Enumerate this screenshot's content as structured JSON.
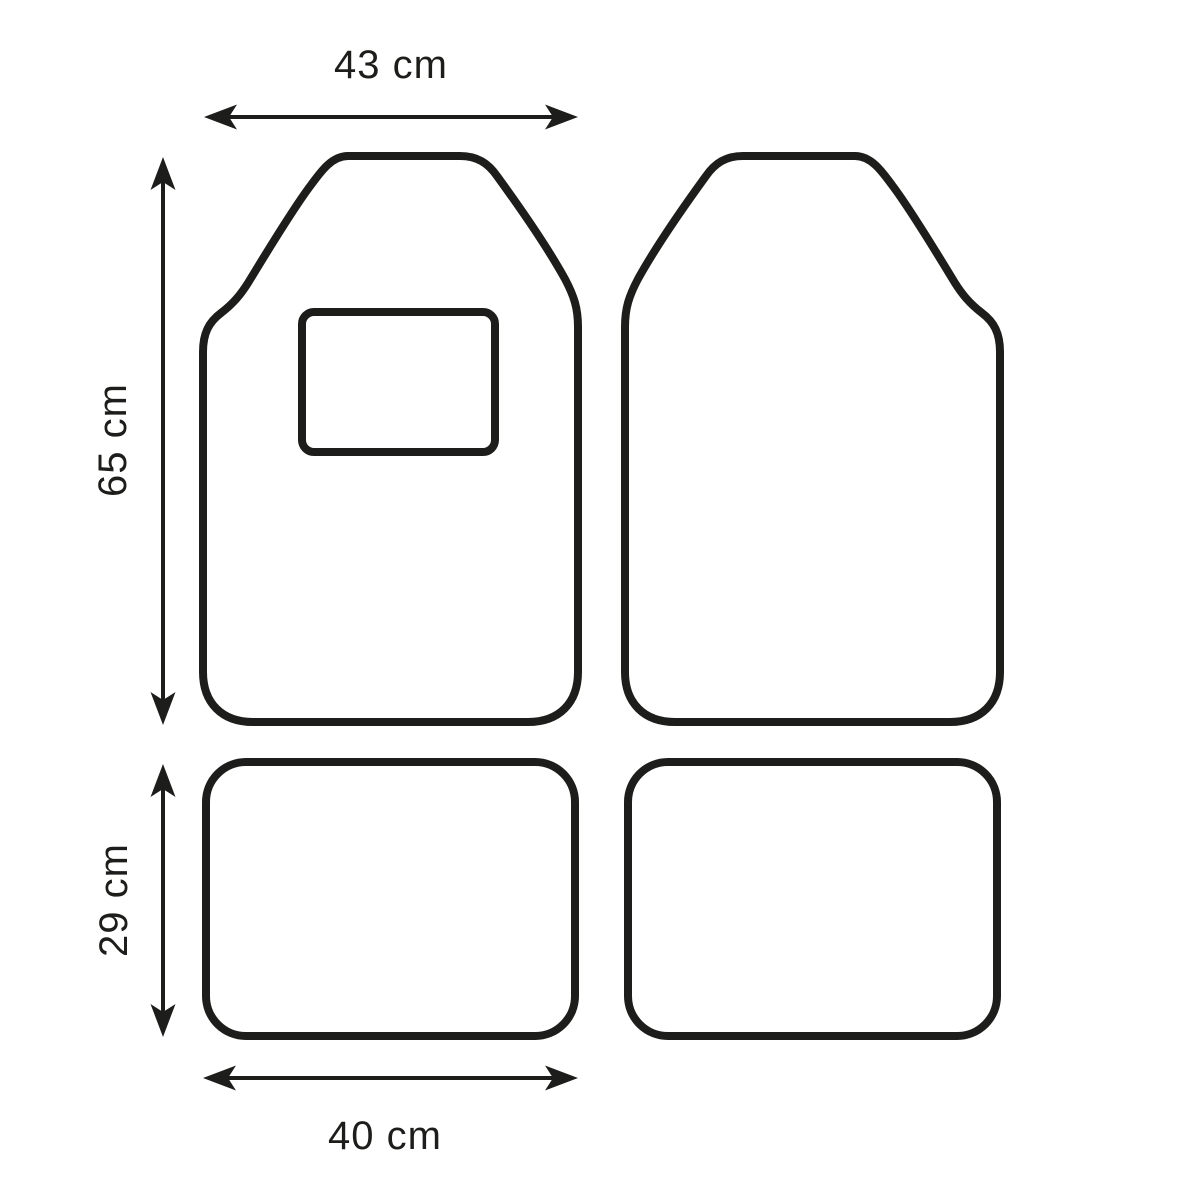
{
  "diagram": {
    "subject": "floor-mat-set-dimension-drawing",
    "background_color": "#ffffff",
    "line_color": "#1d1d1b",
    "dimensions": {
      "front_width": {
        "label": "43 cm",
        "value": 43,
        "unit": "cm"
      },
      "front_height": {
        "label": "65 cm",
        "value": 65,
        "unit": "cm"
      },
      "rear_height": {
        "label": "29 cm",
        "value": 29,
        "unit": "cm"
      },
      "rear_width": {
        "label": "40 cm",
        "value": 40,
        "unit": "cm"
      }
    },
    "shapes": [
      {
        "name": "front-left-mat",
        "has_heel_pad": true
      },
      {
        "name": "front-right-mat",
        "has_heel_pad": false
      },
      {
        "name": "rear-left-mat",
        "has_heel_pad": false
      },
      {
        "name": "rear-right-mat",
        "has_heel_pad": false
      }
    ]
  }
}
